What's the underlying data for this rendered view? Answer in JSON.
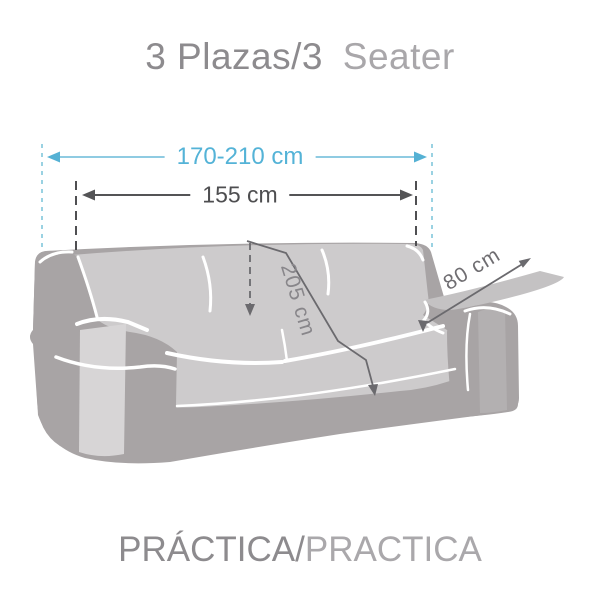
{
  "title": {
    "primary": "3 Plazas/3",
    "secondary": "Seater"
  },
  "footer": {
    "primary": "PRÁCTICA/",
    "secondary": "PRACTICA"
  },
  "dimensions": {
    "overall_width": "170-210 cm",
    "cover_width": "155 cm",
    "cover_length": "205 cm",
    "side_flap_width": "80 cm"
  },
  "colors": {
    "accent_blue": "#54b3d7",
    "dimension_gray": "#4e4e50",
    "sofa_body_gray": "#a8a4a5",
    "sofa_cover_gray": "#cdcbcc",
    "pocket_gray": "#d7d5d6",
    "flap_gray": "#c4c2c3"
  }
}
